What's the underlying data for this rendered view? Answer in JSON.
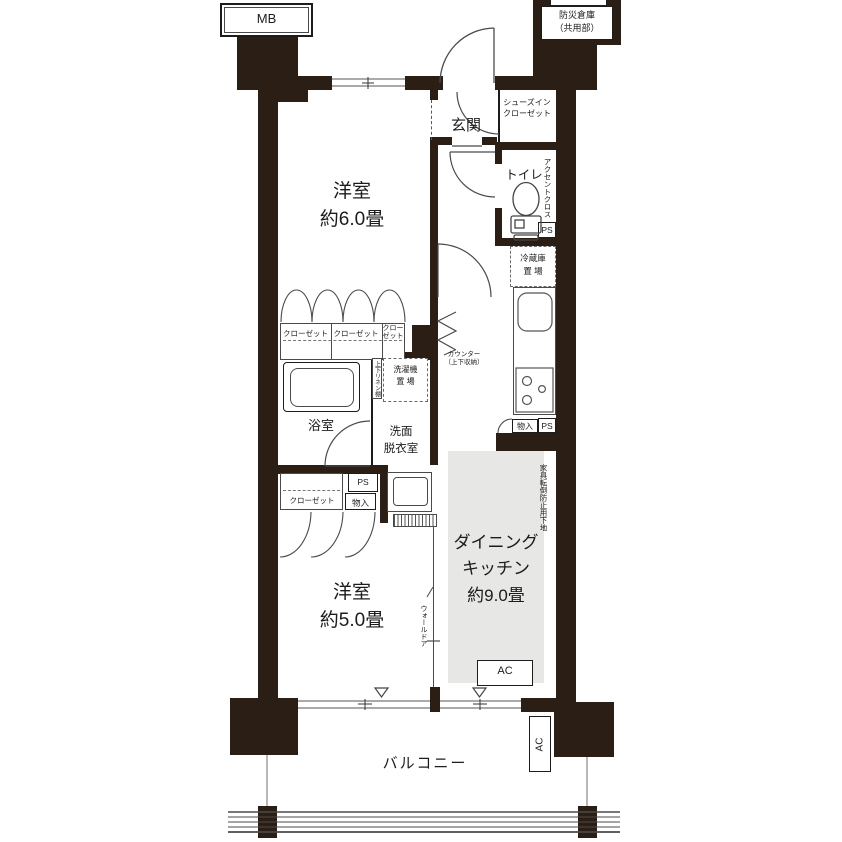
{
  "title": "マンション間取り図 2DK",
  "labels": {
    "mb": "MB",
    "bousai1": "防災倉庫",
    "bousai2": "（共用部）",
    "genkan": "玄関",
    "shoes1": "シューズイン",
    "shoes2": "クローゼット",
    "toilet": "トイレ",
    "accent": "アクセントクロス",
    "ps": "PS",
    "fridge1": "冷蔵庫",
    "fridge2": "置 場",
    "bedroom6_name": "洋室",
    "bedroom6_size": "約6.0畳",
    "closet": "クローゼット",
    "closet_s1": "クロー",
    "closet_s2": "ゼット",
    "counter1": "カウンター",
    "counter2": "（上下収納）",
    "linen": "上下リネン棚",
    "washer1": "洗濯機",
    "washer2": "置 場",
    "bath": "浴室",
    "senmen1": "洗面",
    "senmen2": "脱衣室",
    "monoire": "物入",
    "dk1": "ダイニング",
    "dk2": "キッチン",
    "dk3": "約9.0畳",
    "kagu": "家具転倒防止用下地",
    "walldoor": "ウォールドア",
    "bedroom5_name": "洋室",
    "bedroom5_size": "約5.0畳",
    "ac": "AC",
    "balcony": "バルコニー"
  },
  "colors": {
    "wall": "#2b1e15",
    "line": "#4a4a4a",
    "gray": "#e7e7e6",
    "winline": "#8e8e8e",
    "ink": "#1c1c1c"
  }
}
